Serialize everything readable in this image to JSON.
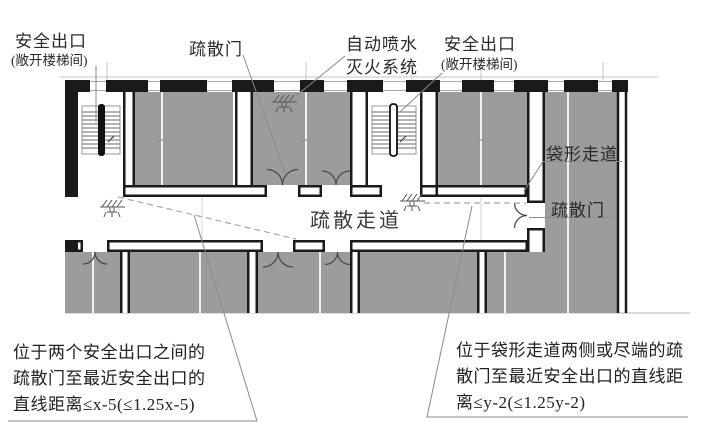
{
  "diagram": {
    "title_labels": {
      "exit_left": {
        "title": "安全出口",
        "subtitle": "(敞开楼梯间)"
      },
      "evac_door_top": "疏散门",
      "sprinkler_system": {
        "line1": "自动喷水",
        "line2": "灭火系统"
      },
      "exit_right": {
        "title": "安全出口",
        "subtitle": "(敞开楼梯间)"
      },
      "dead_end_corridor": "袋形走道",
      "evac_door_right": "疏散门",
      "corridor": "疏散走道"
    },
    "notes": {
      "left": {
        "line1": "位于两个安全出口之间的",
        "line2": "疏散门至最近安全出口的",
        "line3": "直线距离≤x-5(≤1.25x-5)"
      },
      "right": {
        "line1": "位于袋形走道两侧或尽端的疏",
        "line2": "散门至最近安全出口的直线距",
        "line3": "离≤y-2(≤1.25y-2)"
      }
    },
    "colors": {
      "room_fill": "#9c9c9c",
      "wall": "#1a1a1a",
      "leader": "#8a8a8a",
      "dashed_path": "#a8a8a8",
      "background": "#ffffff"
    }
  }
}
